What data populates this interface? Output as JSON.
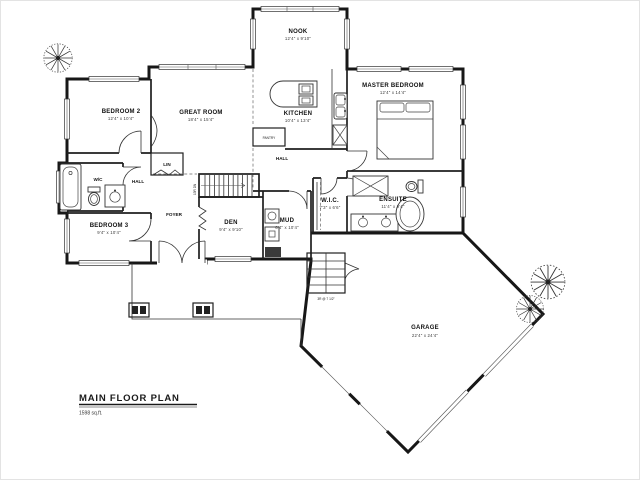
{
  "plan": {
    "title": "MAIN FLOOR PLAN",
    "area": "1598 sq.ft.",
    "rooms": {
      "bedroom2": {
        "label": "BEDROOM 2",
        "dims": "12'4\" x 10'4\""
      },
      "great_room": {
        "label": "GREAT ROOM",
        "dims": "18'4\" x 15'4\""
      },
      "nook": {
        "label": "NOOK",
        "dims": "12'4\" x 9'10\""
      },
      "kitchen": {
        "label": "KITCHEN",
        "dims": "10'4\" x 13'4\""
      },
      "master_bedroom": {
        "label": "MASTER BEDROOM",
        "dims": "12'4\" x 14'4\""
      },
      "bedroom3": {
        "label": "BEDROOM 3",
        "dims": "9'4\" x 10'4\""
      },
      "den": {
        "label": "DEN",
        "dims": "9'4\" x 9'10\""
      },
      "mud": {
        "label": "MUD",
        "dims": "6'4\" x 10'4\""
      },
      "wic": {
        "label": "W.I.C.",
        "dims": "7'3\" x 6'6\""
      },
      "ensuite": {
        "label": "ENSUITE",
        "dims": "11'4\" x 9'4\""
      },
      "garage": {
        "label": "GARAGE",
        "dims": "22'4\" x 24'4\""
      },
      "foyer": {
        "label": "FOYER"
      },
      "hall_left": {
        "label": "HALL"
      },
      "hall_center": {
        "label": "HALL"
      },
      "lin": {
        "label": "LIN"
      },
      "wc": {
        "label": "W/C"
      },
      "pantry": {
        "label": "PANTRY"
      }
    },
    "notes": {
      "stair_down": "13R DN",
      "garage_steps": "3R @ 7 1/2\""
    },
    "colors": {
      "line": "#1a1a1a",
      "background": "#ffffff"
    }
  }
}
